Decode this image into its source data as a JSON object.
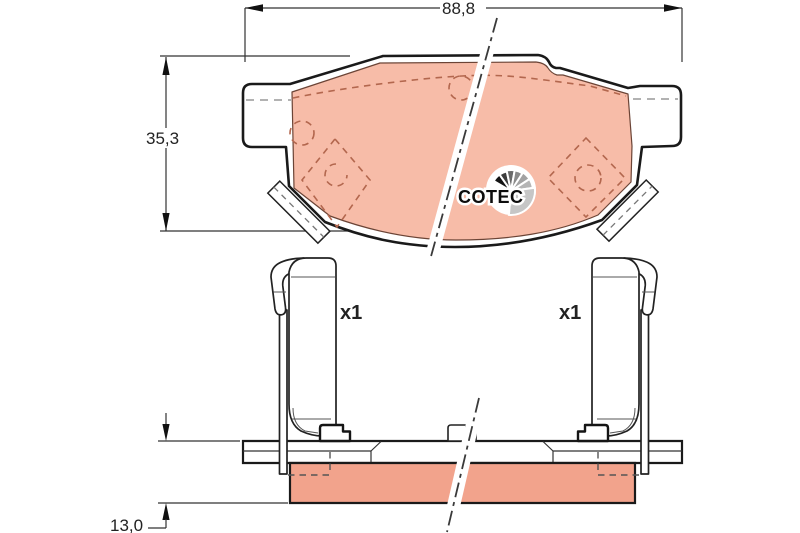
{
  "drawing": {
    "title_hint": "brake pad technical drawing",
    "labels": {
      "width_mm": "88,8",
      "height_mm": "35,3",
      "thickness_mm": "13,0",
      "clip_left_qty": "x1",
      "clip_right_qty": "x1",
      "logo": "COTEC"
    },
    "colors": {
      "line": "#1a1a1a",
      "dimension_line": "#333333",
      "friction_front": "#f7bca8",
      "friction_side": "#f2a38c",
      "detail_dash": "#b3674e",
      "hidden_dash": "#999999",
      "logo_fan_grays": [
        "#141414",
        "#3d3d3d",
        "#6a6a6a",
        "#8a8a8a",
        "#a2a2a2",
        "#b5b5b5",
        "#c6c6c6"
      ]
    }
  }
}
